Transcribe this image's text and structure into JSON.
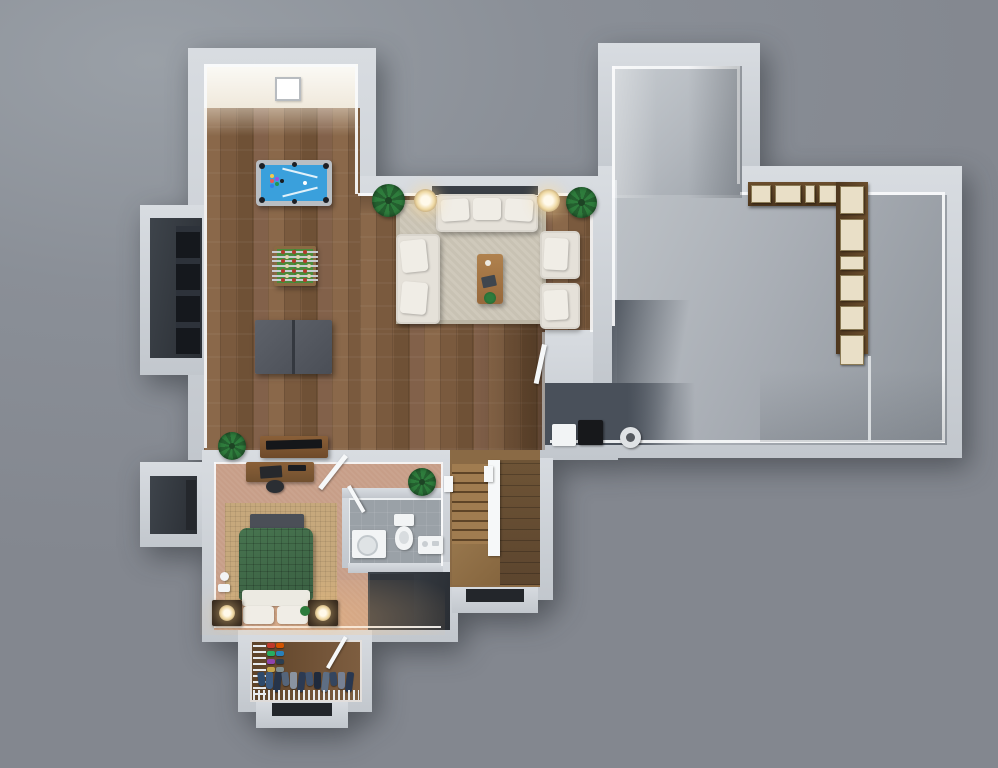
{
  "meta": {
    "title": "3D basement floor plan, top-down render",
    "render_style": "photoreal 3D dollhouse view",
    "visible_text": "none"
  },
  "palette": {
    "bg": "#8A8F97",
    "bgLight": "#9AA0A7",
    "wall": "#D8DCE1",
    "wallDark": "#C2C7CD",
    "trim": "#F4F6F8",
    "woodA": "#8A684A",
    "woodB": "#7A5A3E",
    "woodC": "#6F5136",
    "woodD": "#82614A",
    "woodDark": "#5E4730",
    "concreteA": "#BDC2C7",
    "concreteB": "#A9AEB5",
    "concreteC": "#8E949B",
    "slate": "#4E555F",
    "carpet": "#C79E88",
    "bedRug": "#C6A87C",
    "rug": "#CFC9BB",
    "rugBorder": "#BCB5A4",
    "sofa": "#E5E1D9",
    "cushion": "#F0EDE6",
    "felt": "#3AA0DC",
    "tableFrame": "#B9BEC3",
    "foosField": "#4B8A3A",
    "foosFrame": "#8A6A43",
    "pingpong": "#565A61",
    "duvetA": "#47744F",
    "duvetB": "#3A5F42",
    "bench": "#4B4F57",
    "nightstand": "#2E2218",
    "glow": "#FFD9A6",
    "bathFloor": "#9AA1A7",
    "fixture": "#F2F4F5",
    "stairLight": "#A07C50",
    "stairMid": "#8A6A45",
    "stairDark": "#5C452E",
    "closetFloor": "#6B4E35",
    "darkRoom": "#3E444B",
    "darkerRoom": "#2A2E34",
    "shelfWood": "#76572F",
    "box": "#E9DFC7",
    "plant": "#2E7C3C",
    "plantDark": "#245F2F",
    "white": "#F6F8F9",
    "black": "#1A1C20"
  },
  "rooms": [
    {
      "id": "game-room",
      "floor": "hardwood",
      "contents": [
        "pool-table",
        "foosball-table",
        "ping-pong-table",
        "tv-console",
        "wall-frame"
      ]
    },
    {
      "id": "living-area",
      "floor": "hardwood",
      "contents": [
        "three-seat-sofa",
        "loveseat",
        "armchair",
        "armchair",
        "coffee-table",
        "area-rug",
        "table-lamp",
        "table-lamp",
        "potted-plant",
        "potted-plant"
      ]
    },
    {
      "id": "unfinished-storage-room",
      "floor": "concrete",
      "contents": [
        "l-shaped-shelving",
        "storage-boxes",
        "white-box",
        "black-box",
        "paint-roll"
      ]
    },
    {
      "id": "bedroom",
      "floor": "carpet",
      "contents": [
        "bed",
        "foot-bench",
        "nightstand",
        "nightstand",
        "desk",
        "office-chair",
        "area-rug"
      ]
    },
    {
      "id": "bathroom",
      "floor": "tile",
      "contents": [
        "washer",
        "toilet",
        "vanity"
      ]
    },
    {
      "id": "walk-in-closet",
      "floor": "hardwood",
      "contents": [
        "wire-shelving",
        "hanging-clothes",
        "shoe-rack"
      ]
    },
    {
      "id": "staircase",
      "floor": "hardwood",
      "contents": [
        "treads",
        "railing",
        "landing",
        "newel-posts"
      ]
    },
    {
      "id": "storage-nook-upper",
      "floor": "dark",
      "contents": [
        "shelf-rack"
      ]
    },
    {
      "id": "storage-nook-lower",
      "floor": "dark",
      "contents": [
        "window-well"
      ]
    },
    {
      "id": "under-stair-storage",
      "floor": "dark",
      "contents": []
    }
  ],
  "generated": {
    "clothes_colors": [
      "#2E4A6B",
      "#3B5A80",
      "#26344A",
      "#55657A",
      "#8A93A0",
      "#2C3A52",
      "#41536E",
      "#1F2A3C",
      "#5E6E84",
      "#34455E",
      "#768093",
      "#283750"
    ],
    "shoe_colors": [
      "#C0392B",
      "#D35400",
      "#27AE60",
      "#2980B9",
      "#8E44AD",
      "#2C3E50",
      "#C2A24B",
      "#7F8C8D"
    ],
    "shelf_top_box_widths": [
      18,
      24,
      8,
      16,
      14
    ],
    "shelf_right_box_heights": [
      26,
      30,
      12,
      24,
      22,
      28
    ],
    "foosball_rod_count": 7,
    "foosball_team_colors": [
      "#B33B2B",
      "#E2D3B0"
    ],
    "pool_ball_colors": [
      "#F2C94C",
      "#EB5757",
      "#2F80ED",
      "#9B51E0",
      "#219653",
      "#1A1C20"
    ],
    "stair_tread_count": 8
  }
}
